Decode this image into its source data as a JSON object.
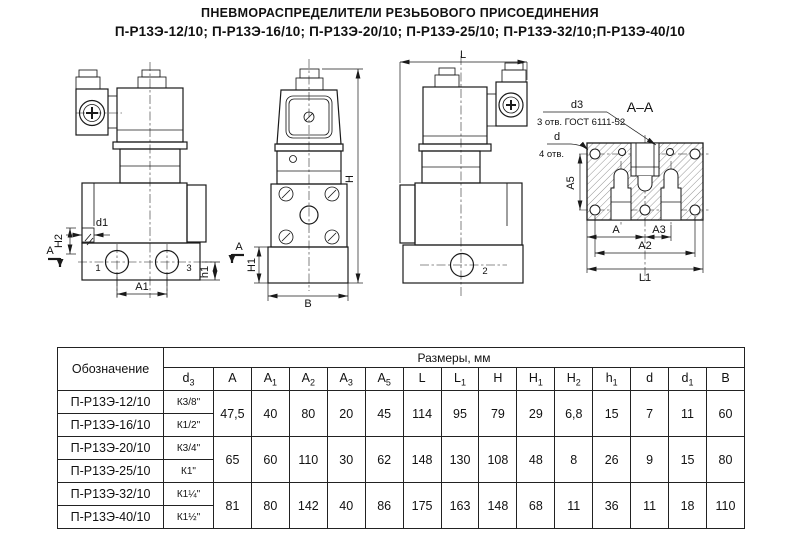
{
  "title": {
    "line1": "ПНЕВМОРАСПРЕДЕЛИТЕЛИ РЕЗЬБОВОГО ПРИСОЕДИНЕНИЯ",
    "line2": "П-Р13Э-12/10; П-Р13Э-16/10; П-Р13Э-20/10; П-Р13Э-25/10; П-Р13Э-32/10;П-Р13Э-40/10"
  },
  "drawings": {
    "front_view": {
      "section_letter": "A",
      "dim_d1": "d1",
      "dim_h2": "H2",
      "dim_a1": "A1",
      "dim_h1": "h1",
      "port_left": "1",
      "port_right": "3"
    },
    "side_view": {
      "dim_h": "H",
      "dim_h1": "H1",
      "dim_b": "B"
    },
    "back_view": {
      "dim_l": "L",
      "port": "2"
    },
    "section_view": {
      "title": "А–А",
      "d3_label": "d3",
      "d3_note": "3 отв. ГОСТ 6111-52",
      "d_label": "d",
      "d_note": "4 отв.",
      "dim_a5": "A5",
      "dim_a": "A",
      "dim_a3": "A3",
      "dim_a2": "A2",
      "dim_l1": "L1"
    }
  },
  "table": {
    "designation_header": "Обозначение",
    "sizes_header": "Размеры, мм",
    "columns": [
      {
        "label": "d",
        "sub": "3"
      },
      {
        "label": "A",
        "sub": ""
      },
      {
        "label": "A",
        "sub": "1"
      },
      {
        "label": "A",
        "sub": "2"
      },
      {
        "label": "A",
        "sub": "3"
      },
      {
        "label": "A",
        "sub": "5"
      },
      {
        "label": "L",
        "sub": ""
      },
      {
        "label": "L",
        "sub": "1"
      },
      {
        "label": "H",
        "sub": ""
      },
      {
        "label": "H",
        "sub": "1"
      },
      {
        "label": "H",
        "sub": "2"
      },
      {
        "label": "h",
        "sub": "1"
      },
      {
        "label": "d",
        "sub": ""
      },
      {
        "label": "d",
        "sub": "1"
      },
      {
        "label": "B",
        "sub": ""
      }
    ],
    "groups": [
      {
        "rows": [
          {
            "name": "П-Р13Э-12/10",
            "d3": "К3/8\""
          },
          {
            "name": "П-Р13Э-16/10",
            "d3": "К1/2\""
          }
        ],
        "values": [
          "47,5",
          "40",
          "80",
          "20",
          "45",
          "114",
          "95",
          "79",
          "29",
          "6,8",
          "15",
          "7",
          "11",
          "60"
        ]
      },
      {
        "rows": [
          {
            "name": "П-Р13Э-20/10",
            "d3": "К3/4\""
          },
          {
            "name": "П-Р13Э-25/10",
            "d3": "К1\""
          }
        ],
        "values": [
          "65",
          "60",
          "110",
          "30",
          "62",
          "148",
          "130",
          "108",
          "48",
          "8",
          "26",
          "9",
          "15",
          "80"
        ]
      },
      {
        "rows": [
          {
            "name": "П-Р13Э-32/10",
            "d3": "К1¼\""
          },
          {
            "name": "П-Р13Э-40/10",
            "d3": "К1½\""
          }
        ],
        "values": [
          "81",
          "80",
          "142",
          "40",
          "86",
          "175",
          "163",
          "148",
          "68",
          "11",
          "36",
          "11",
          "18",
          "110"
        ]
      }
    ]
  },
  "colors": {
    "line": "#1a1a1a",
    "background": "#ffffff"
  }
}
